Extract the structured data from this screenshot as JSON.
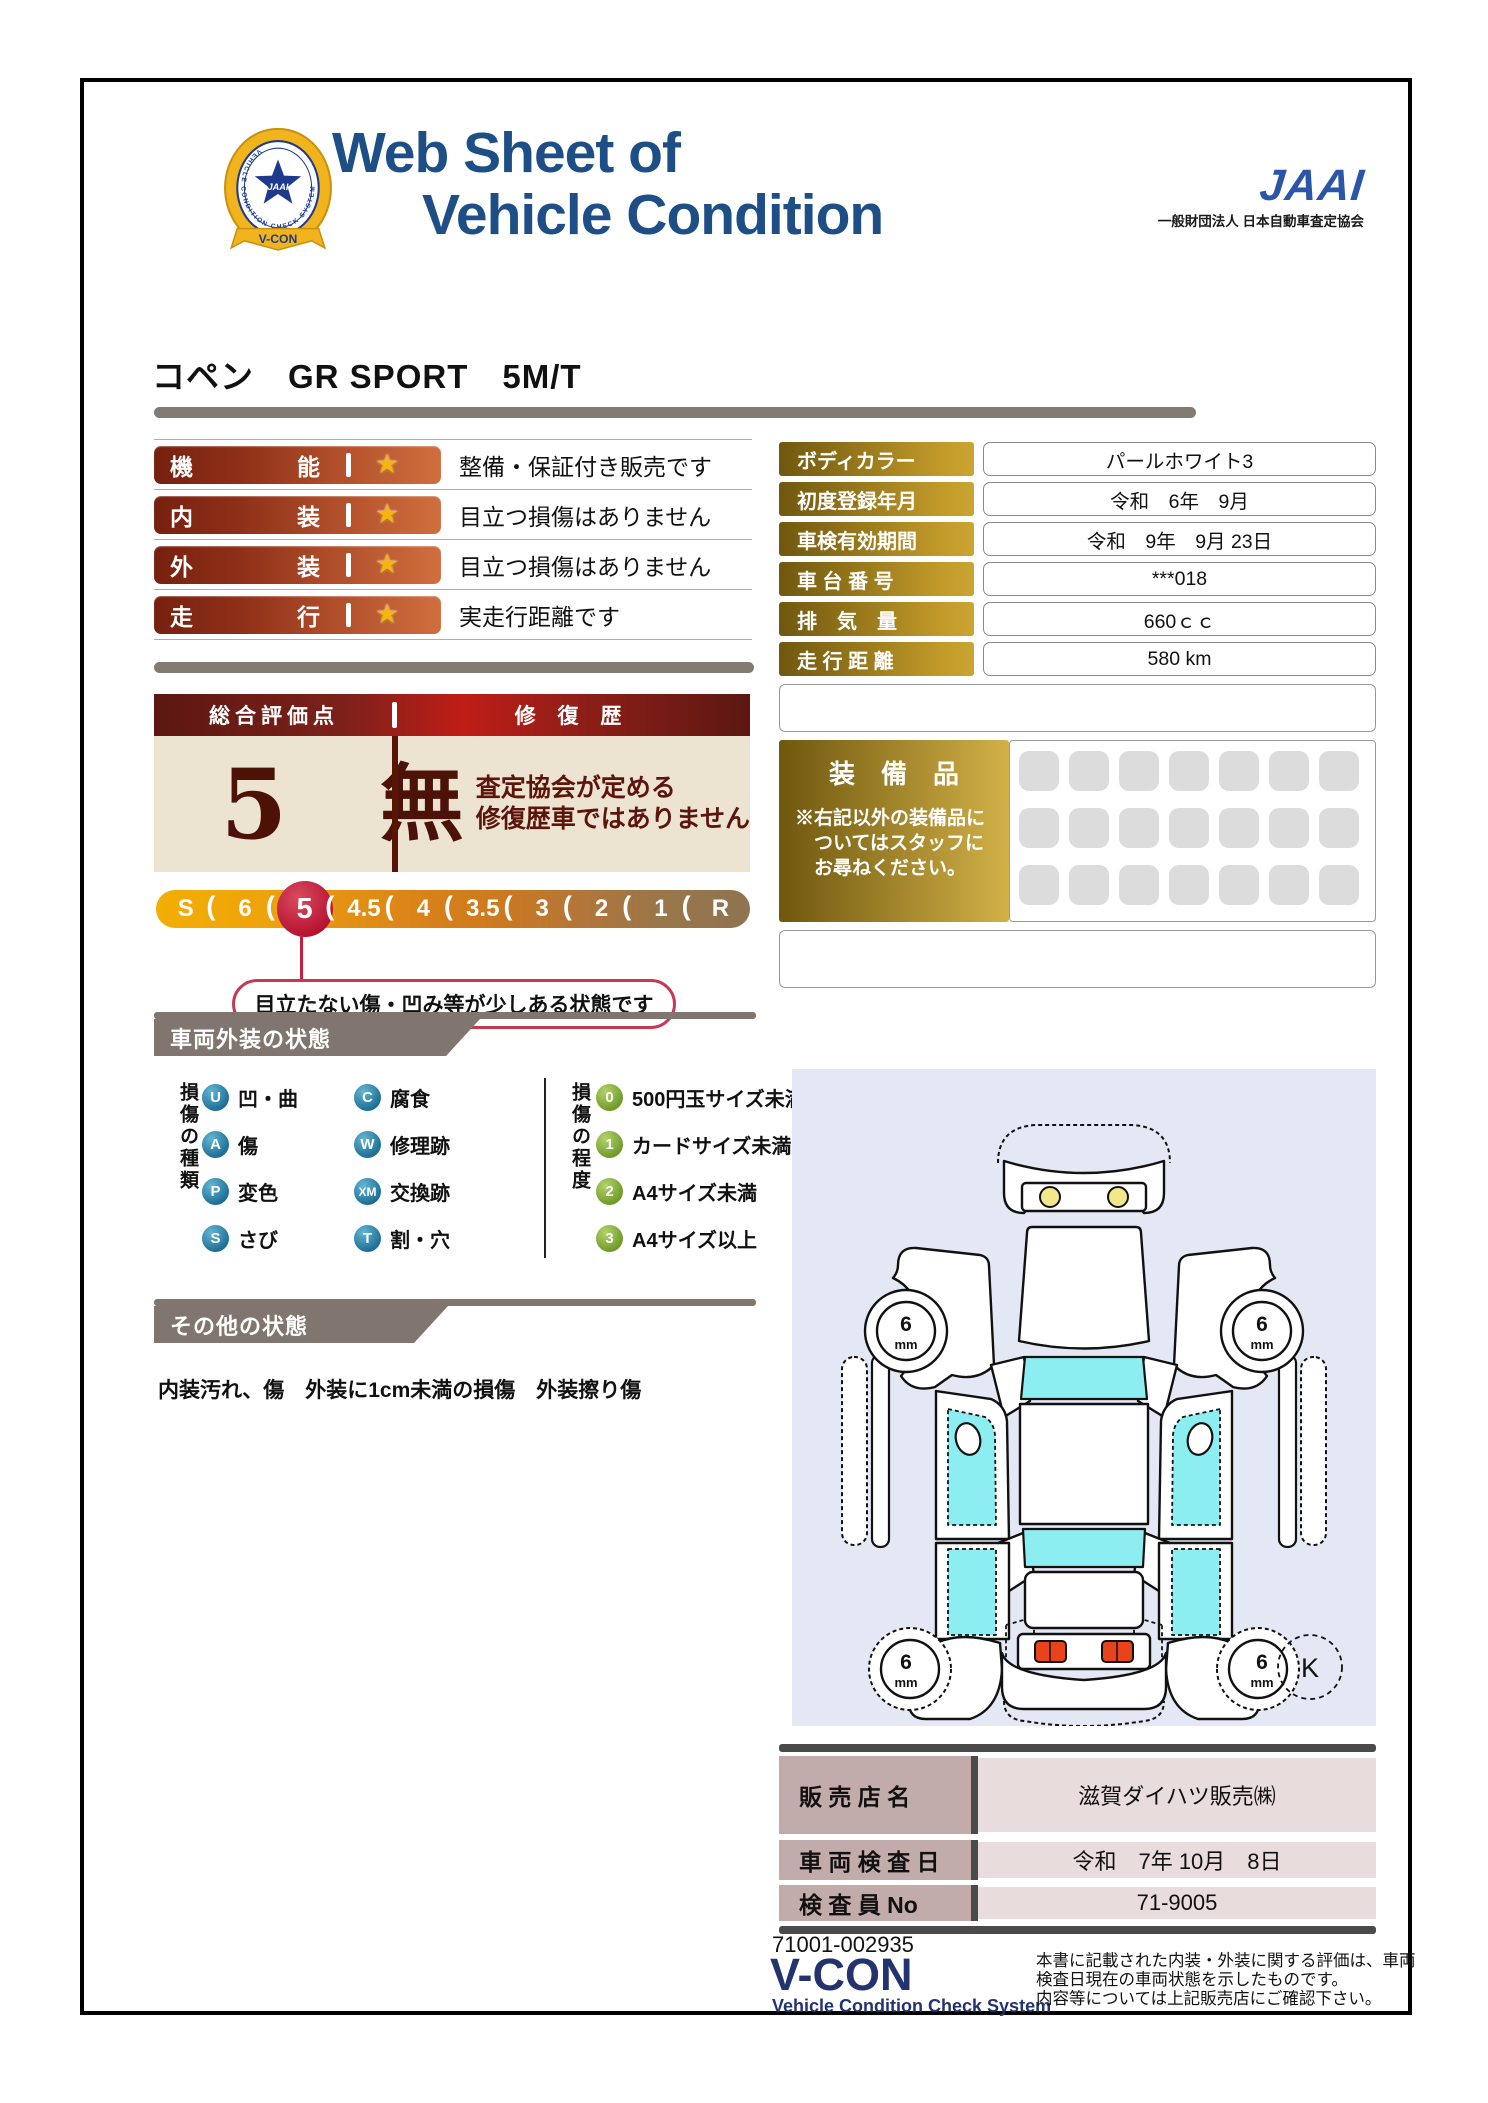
{
  "header": {
    "title_line1": "Web Sheet of",
    "title_line2": "Vehicle Condition",
    "vcon_logo": {
      "belt_text": "VEHICLE CONDITION CHECK SYSTEM",
      "star_label": "JAAI",
      "ribbon_label": "V-CON"
    },
    "jaai_logo": "JAAI",
    "jaai_org": "一般財団法人 日本自動車査定協会"
  },
  "vehicle_name": "コペン　GR SPORT　5M/T",
  "icons": {
    "star": "★",
    "scale_separator": "("
  },
  "ratings": [
    {
      "label": "機能",
      "description": "整備・保証付き販売です"
    },
    {
      "label": "内装",
      "description": "目立つ損傷はありません"
    },
    {
      "label": "外装",
      "description": "目立つ損傷はありません"
    },
    {
      "label": "走行",
      "description": "実走行距離です"
    }
  ],
  "overall": {
    "score_label": "総合評価点",
    "repair_label": "修 復 歴",
    "score": "5",
    "repair_value": "無",
    "repair_note_lines": [
      "査定協会が定める",
      "修復歴車ではありません"
    ]
  },
  "scale": {
    "items": [
      "S",
      "6",
      "5",
      "4.5",
      "4",
      "3.5",
      "3",
      "2",
      "1",
      "R"
    ],
    "selected": "5",
    "callout": "目立たない傷・凹み等が少しある状態です"
  },
  "info_table": [
    {
      "label": "ボディカラー",
      "value": "パールホワイト3"
    },
    {
      "label": "初度登録年月",
      "value": "令和　6年　9月"
    },
    {
      "label": "車検有効期間",
      "value": "令和　9年　9月 23日"
    },
    {
      "label": "車 台 番 号",
      "value": "***018"
    },
    {
      "label": "排　気　量",
      "value": "660ｃｃ"
    },
    {
      "label": "走 行 距 離",
      "value": "580 km"
    }
  ],
  "equipment": {
    "title": "装　備　品",
    "note_lines": [
      "※右記以外の装備品に",
      "　ついてはスタッフに",
      "　お尋ねください。"
    ],
    "rows": 3,
    "cols": 7
  },
  "exterior": {
    "section_title": "車両外装の状態",
    "types_label": "損傷の種類",
    "types": [
      {
        "code": "U",
        "label": "凹・曲"
      },
      {
        "code": "C",
        "label": "腐食"
      },
      {
        "code": "A",
        "label": "傷"
      },
      {
        "code": "W",
        "label": "修理跡"
      },
      {
        "code": "P",
        "label": "変色"
      },
      {
        "code": "XM",
        "label": "交換跡"
      },
      {
        "code": "S",
        "label": "さび"
      },
      {
        "code": "T",
        "label": "割・穴"
      }
    ],
    "levels_label": "損傷の程度",
    "levels": [
      {
        "code": "0",
        "label": "500円玉サイズ未満"
      },
      {
        "code": "1",
        "label": "カードサイズ未満"
      },
      {
        "code": "2",
        "label": "A4サイズ未満"
      },
      {
        "code": "3",
        "label": "A4サイズ以上"
      }
    ]
  },
  "other": {
    "section_title": "その他の状態",
    "text": "内装汚れ、傷　外装に1cm未満の損傷　外装擦り傷"
  },
  "diagram": {
    "tread_value": "6",
    "tread_unit": "mm",
    "corner_mark": "K"
  },
  "dealer_table": [
    {
      "label": "販 売 店 名",
      "value": "滋賀ダイハツ販売㈱"
    },
    {
      "label": "車 両 検 査 日",
      "value": "令和　7年 10月　8日"
    },
    {
      "label": "検 査 員 No",
      "value": "71-9005"
    }
  ],
  "footer": {
    "doc_number": "71001-002935",
    "vcon_title": "V-CON",
    "vcon_subtitle": "Vehicle Condition Check System",
    "disclaimer_lines": [
      "本書に記載された内装・外装に関する評価は、車両",
      "検査日現在の車両状態を示したものです。",
      "内容等については上記販売店にご確認下さい。"
    ]
  },
  "colors": {
    "accent_navy": "#1d4e86",
    "maroon": "#5c170f",
    "crimson": "#c51f3d",
    "gold_dark": "#6f570e",
    "gold_light": "#d2b148",
    "lavender": "#e4e8f5",
    "cyan": "#8ceef0",
    "taupe": "#81766f"
  }
}
